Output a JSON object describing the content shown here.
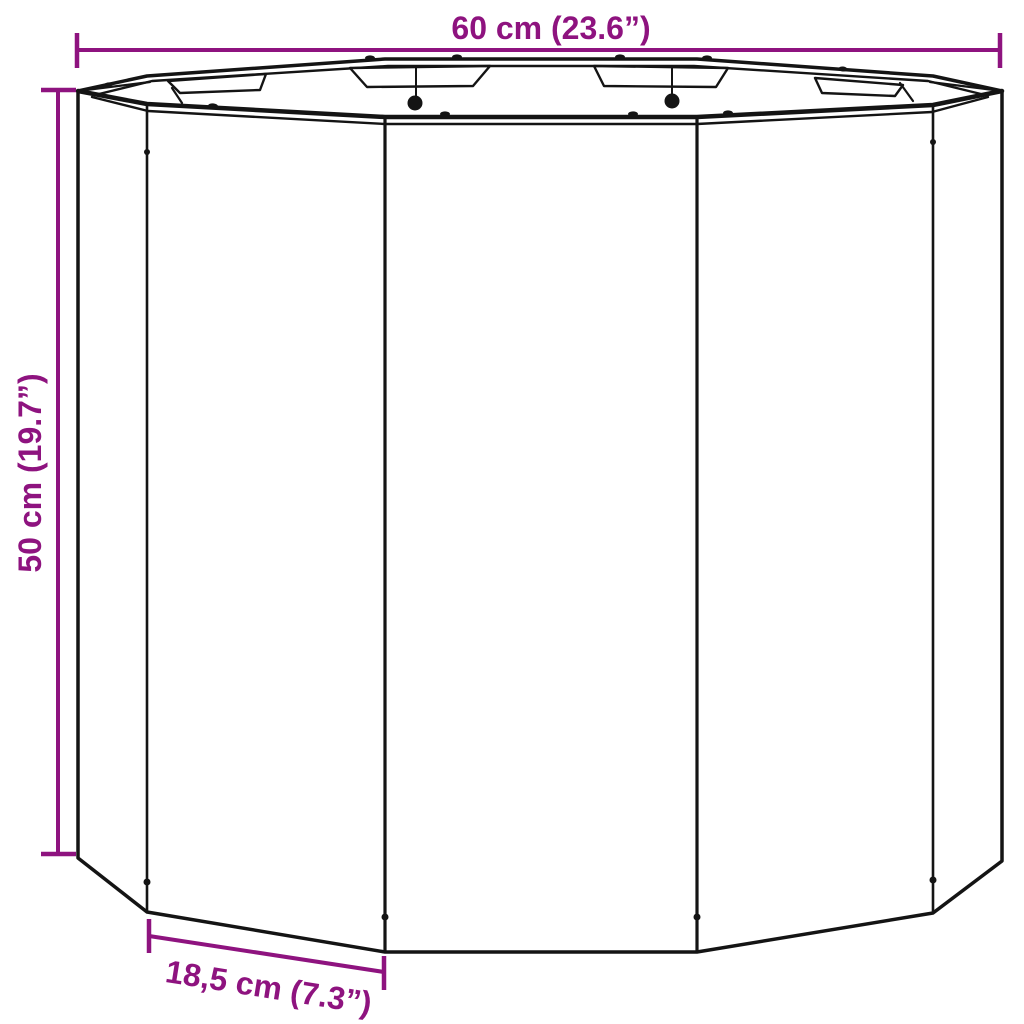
{
  "dimensions": {
    "width": {
      "label": "60 cm (23.6”)"
    },
    "height": {
      "label": "50 cm (19.7”)"
    },
    "panel_width": {
      "label": "18,5 cm (7.3”)"
    }
  },
  "colors": {
    "dimension_accent": "#8E137F",
    "line_ink": "#141414",
    "background": "#FFFFFF"
  }
}
